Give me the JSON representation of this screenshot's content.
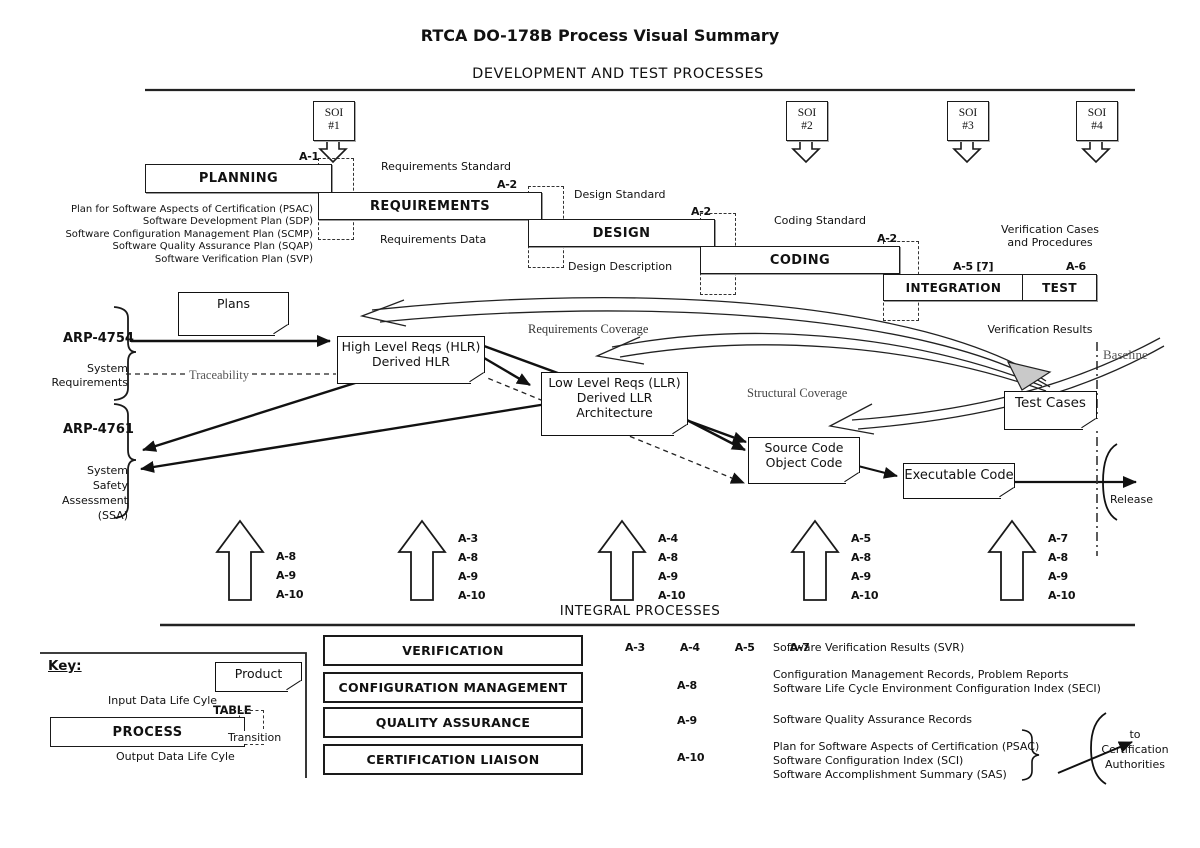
{
  "title": "RTCA DO-178B Process Visual Summary",
  "section_dev": "DEVELOPMENT AND TEST PROCESSES",
  "section_integral": "INTEGRAL PROCESSES",
  "soi": [
    {
      "line1": "SOI",
      "line2": "#1"
    },
    {
      "line1": "SOI",
      "line2": "#2"
    },
    {
      "line1": "SOI",
      "line2": "#3"
    },
    {
      "line1": "SOI",
      "line2": "#4"
    }
  ],
  "waterfall": {
    "boxes": [
      {
        "label": "PLANNING",
        "tag": "A-1"
      },
      {
        "label": "REQUIREMENTS",
        "tag": "A-2"
      },
      {
        "label": "DESIGN",
        "tag": "A-2"
      },
      {
        "label": "CODING",
        "tag": "A-2"
      },
      {
        "label": "INTEGRATION",
        "tag": "A-5 [7]"
      },
      {
        "label": "TEST",
        "tag": "A-6"
      }
    ],
    "artifacts": {
      "requirements_standard": "Requirements Standard",
      "design_standard": "Design Standard",
      "coding_standard": "Coding Standard",
      "requirements_data": "Requirements Data",
      "design_description": "Design Description",
      "verification_cases_1": "Verification Cases",
      "verification_cases_2": "and Procedures"
    },
    "plans_list": [
      "Plan for Software Aspects of Certification (PSAC)",
      "Software Development Plan (SDP)",
      "Software Configuration Management Plan (SCMP)",
      "Software Quality Assurance Plan (SQAP)",
      "Software Verification Plan (SVP)"
    ]
  },
  "middle": {
    "plans_box": "Plans",
    "arp4754": "ARP-4754",
    "system_requirements": [
      "System",
      "Requirements"
    ],
    "traceability": "Traceability",
    "arp4761": "ARP-4761",
    "ssa": [
      "System",
      "Safety",
      "Assessment",
      "(SSA)"
    ],
    "hlr": [
      "High Level Reqs (HLR)",
      "Derived HLR"
    ],
    "llr": [
      "Low Level Reqs (LLR)",
      "Derived LLR",
      "Architecture"
    ],
    "source": [
      "Source Code",
      "Object Code"
    ],
    "executable": "Executable Code",
    "test_cases": "Test Cases",
    "requirements_coverage": "Requirements Coverage",
    "structural_coverage": "Structural Coverage",
    "verification_results": "Verification Results",
    "baseline": "Baseline",
    "release": "Release"
  },
  "up_arrows": [
    {
      "labels": [
        "A-8",
        "A-9",
        "A-10"
      ]
    },
    {
      "labels": [
        "A-3",
        "A-8",
        "A-9",
        "A-10"
      ]
    },
    {
      "labels": [
        "A-4",
        "A-8",
        "A-9",
        "A-10"
      ]
    },
    {
      "labels": [
        "A-5",
        "A-8",
        "A-9",
        "A-10"
      ]
    },
    {
      "labels": [
        "A-7",
        "A-8",
        "A-9",
        "A-10"
      ]
    }
  ],
  "integral": {
    "rows": [
      {
        "label": "VERIFICATION",
        "tags": "A-3  A-4  A-5  A-7",
        "outputs": [
          "Software Verification Results (SVR)"
        ]
      },
      {
        "label": "CONFIGURATION MANAGEMENT",
        "tags": "A-8",
        "outputs": [
          "Configuration Management Records, Problem Reports",
          "Software Life Cycle Environment Configuration Index (SECI)"
        ]
      },
      {
        "label": "QUALITY ASSURANCE",
        "tags": "A-9",
        "outputs": [
          "Software Quality Assurance Records"
        ]
      },
      {
        "label": "CERTIFICATION LIAISON",
        "tags": "A-10",
        "outputs": [
          "Plan for Software Aspects of Certification (PSAC)",
          "Software Configuration Index (SCI)",
          "Software Accomplishment Summary (SAS)"
        ]
      }
    ],
    "cert_auth": [
      "to",
      "Certification",
      "Authorities"
    ]
  },
  "key": {
    "title": "Key:",
    "product": "Product",
    "input": "Input Data Life Cyle",
    "table": "TABLE",
    "process": "PROCESS",
    "transition": "Transition",
    "output": "Output Data Life Cyle"
  },
  "colors": {
    "ink": "#111111",
    "gray_label": "#555555",
    "ribbon_fill": "#c9c9c9"
  }
}
